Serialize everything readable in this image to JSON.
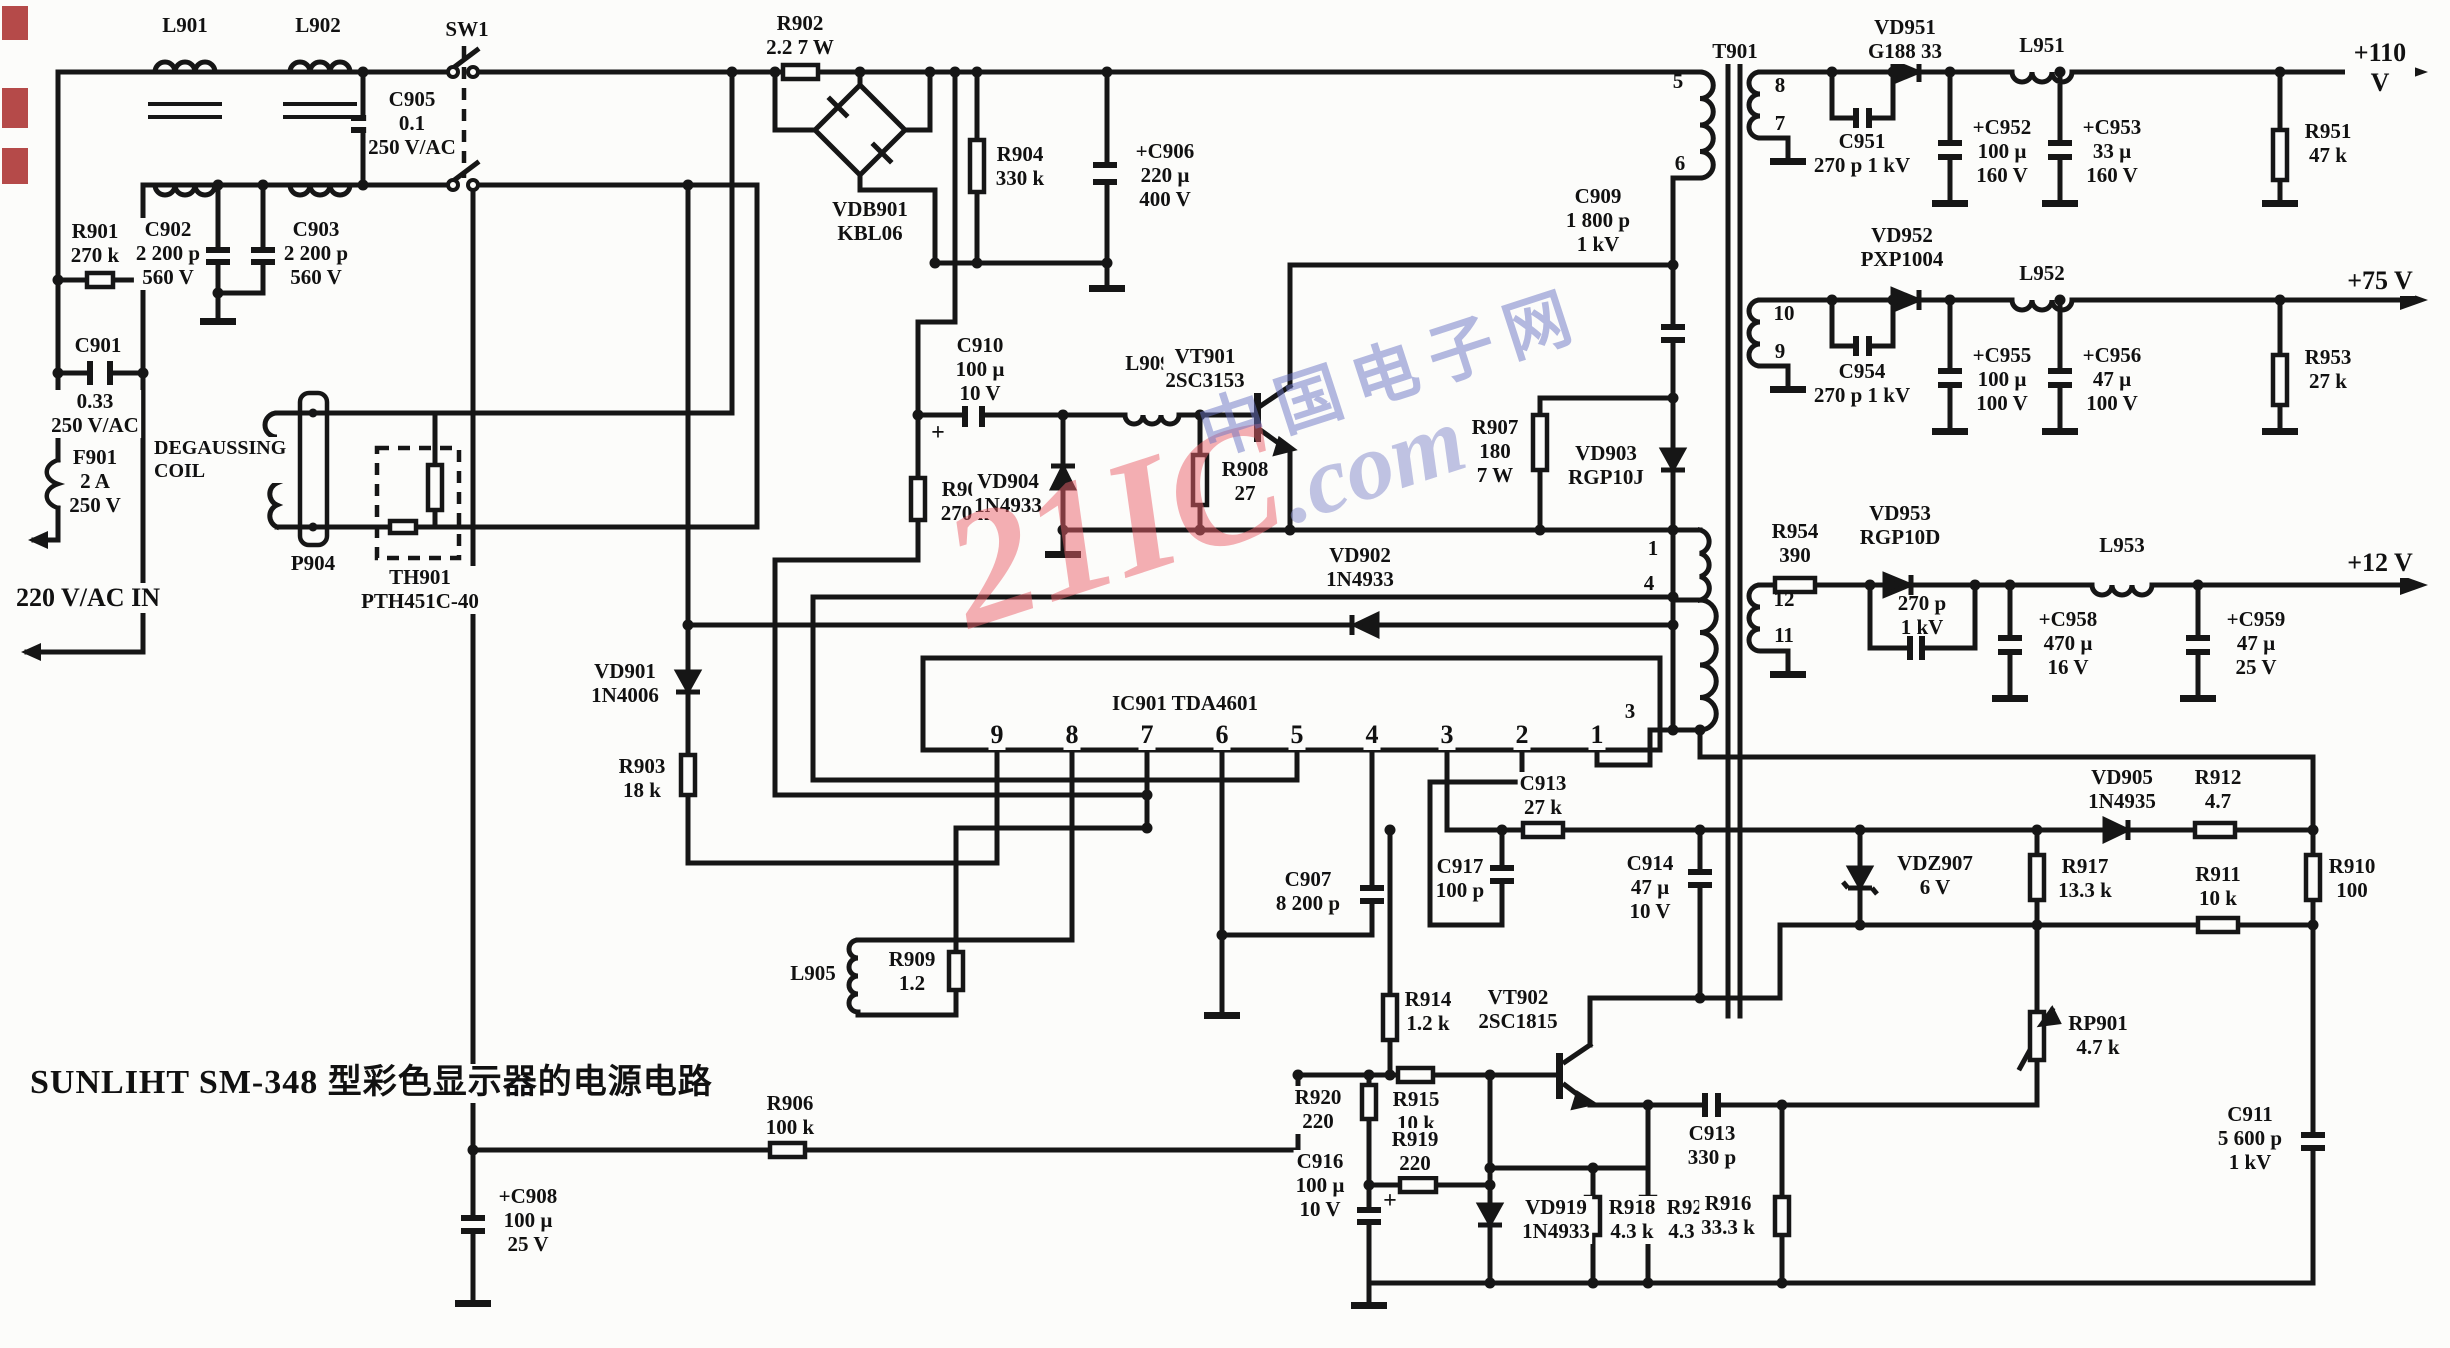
{
  "title": "SUNLIHT SM-348 型彩色显示器的电源电路",
  "watermark": {
    "big": "21IC",
    "com": ".com",
    "cn": "中国电子网"
  },
  "rails": {
    "v110": "+110 V",
    "v75": "+75 V",
    "v12": "+12 V",
    "ac_in": "220 V/AC IN"
  },
  "ic": {
    "label": "IC901  TDA4601",
    "pins": [
      "9",
      "8",
      "7",
      "6",
      "5",
      "4",
      "3",
      "2",
      "1"
    ]
  },
  "t901": {
    "ref": "T901",
    "primary": {
      "p5": "5",
      "p6": "6",
      "p1": "1",
      "p4": "4",
      "p3": "3"
    },
    "secondary": {
      "s8": "8",
      "s7": "7",
      "s10": "10",
      "s9": "9",
      "s12": "12",
      "s11": "11"
    }
  },
  "labels": {
    "l901": "L901",
    "l902": "L902",
    "sw1": "SW1",
    "r902": "R902\n2.2 7 W",
    "c905": "C905\n0.1\n250 V/AC",
    "r901": "R901\n270 k",
    "c902": "C902\n2 200 p\n560 V",
    "c903": "C903\n2 200 p\n560 V",
    "c901a": "C901",
    "c901b": "0.33\n250 V/AC",
    "f901": "F901\n2 A\n250 V",
    "degauss": "DEGAUSSING\nCOIL",
    "p904": "P904",
    "th901": "TH901\nPTH451C-40",
    "vd901": "VD901\n1N4006",
    "r903": "R903\n18 k",
    "vdb901": "VDB901\nKBL06",
    "r904": "R904\n330 k",
    "c906": "+C906\n220 µ\n400 V",
    "c910": "C910\n100 µ\n10 V",
    "r905": "R905\n270 k",
    "vd904": "VD904\n1N4933",
    "l909": "L909",
    "r908": "R908\n27",
    "vt901": "VT901\n2SC3153",
    "c909": "C909\n1 800 p\n1 kV",
    "r907": "R907\n180\n7 W",
    "vd903": "VD903\nRGP10J",
    "vd902": "VD902\n1N4933",
    "c907": "C907\n8 200 p",
    "l905": "L905",
    "r909": "R909\n1.2",
    "r906": "R906\n100 k",
    "c908": "+C908\n100 µ\n25 V",
    "c913a": "C913\n27 k",
    "c917": "C917\n100 p",
    "c914": "C914\n47 µ\n10 V",
    "vdz907": "VDZ907\n6 V",
    "r917": "R917\n13.3 k",
    "vd905": "VD905\n1N4935",
    "r912": "R912\n4.7",
    "r910": "R910\n100",
    "r911": "R911\n10 k",
    "r914": "R914\n1.2 k",
    "vt902": "VT902\n2SC1815",
    "r915": "R915\n10 k",
    "r920": "R920\n220",
    "r919": "R919\n220",
    "c916": "C916\n100 µ\n10 V",
    "vd919": "VD919\n1N4933",
    "r918": "R918\n4.3 k",
    "r921": "R921\n4.3 k",
    "r916": "R916\n33.3 k",
    "rp901": "RP901\n4.7 k",
    "c913b": "C913\n330 p",
    "c911": "C911\n5 600 p\n1 kV",
    "vd951": "VD951\nG188 33",
    "c951": "C951\n270 p 1 kV",
    "c952": "+C952\n100 µ\n160 V",
    "c953": "+C953\n33 µ\n160 V",
    "l951": "L951",
    "r951": "R951\n47 k",
    "vd952": "VD952\nPXP1004",
    "c954": "C954\n270 p 1 kV",
    "c955": "+C955\n100 µ\n100 V",
    "c956": "+C956\n47 µ\n100 V",
    "l952": "L952",
    "r953": "R953\n27 k",
    "r954": "R954\n390",
    "vd953": "VD953\nRGP10D",
    "c957": "270 p\n1 kV",
    "c958": "+C958\n470 µ\n16 V",
    "c959": "+C959\n47 µ\n25 V",
    "l953": "L953",
    "plus": "+"
  }
}
